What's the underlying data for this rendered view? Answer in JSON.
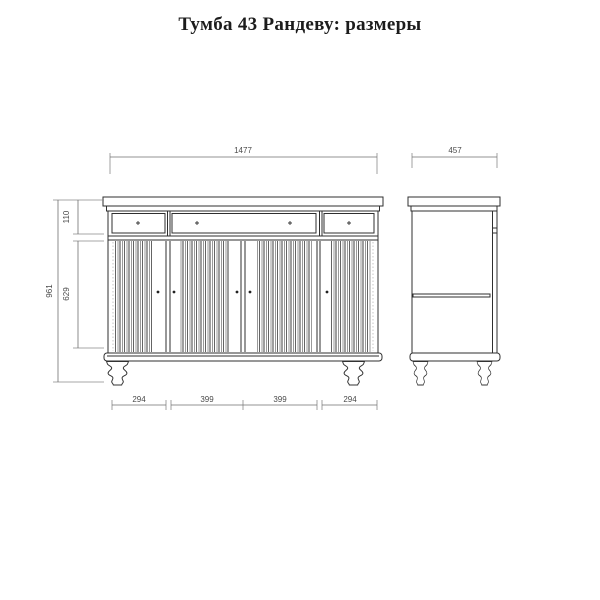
{
  "page": {
    "title": "Тумба 43 Рандеву: размеры"
  },
  "drawing": {
    "type": "furniture-dimension-diagram",
    "views": {
      "front_view": {
        "dimensions": {
          "overall_width": "1477",
          "overall_height": "961",
          "drawer_section_height": "110",
          "door_section_height": "629",
          "bottom_segments": [
            "294",
            "399",
            "399",
            "294"
          ]
        },
        "features": {
          "drawers": 3,
          "doors": 4,
          "legs": 2
        }
      },
      "side_view": {
        "dimensions": {
          "overall_depth": "457"
        },
        "features": {
          "shelf": 1,
          "legs": 2
        }
      }
    },
    "colors": {
      "background": "#ffffff",
      "title_text": "#1c1c1c",
      "outline": "#2f2f2f",
      "dimension_line": "#6f6f6f",
      "dimension_text": "#4a4a4a",
      "flute_dark": "#3d3d3d",
      "flute_light": "#9a9a9a"
    }
  }
}
